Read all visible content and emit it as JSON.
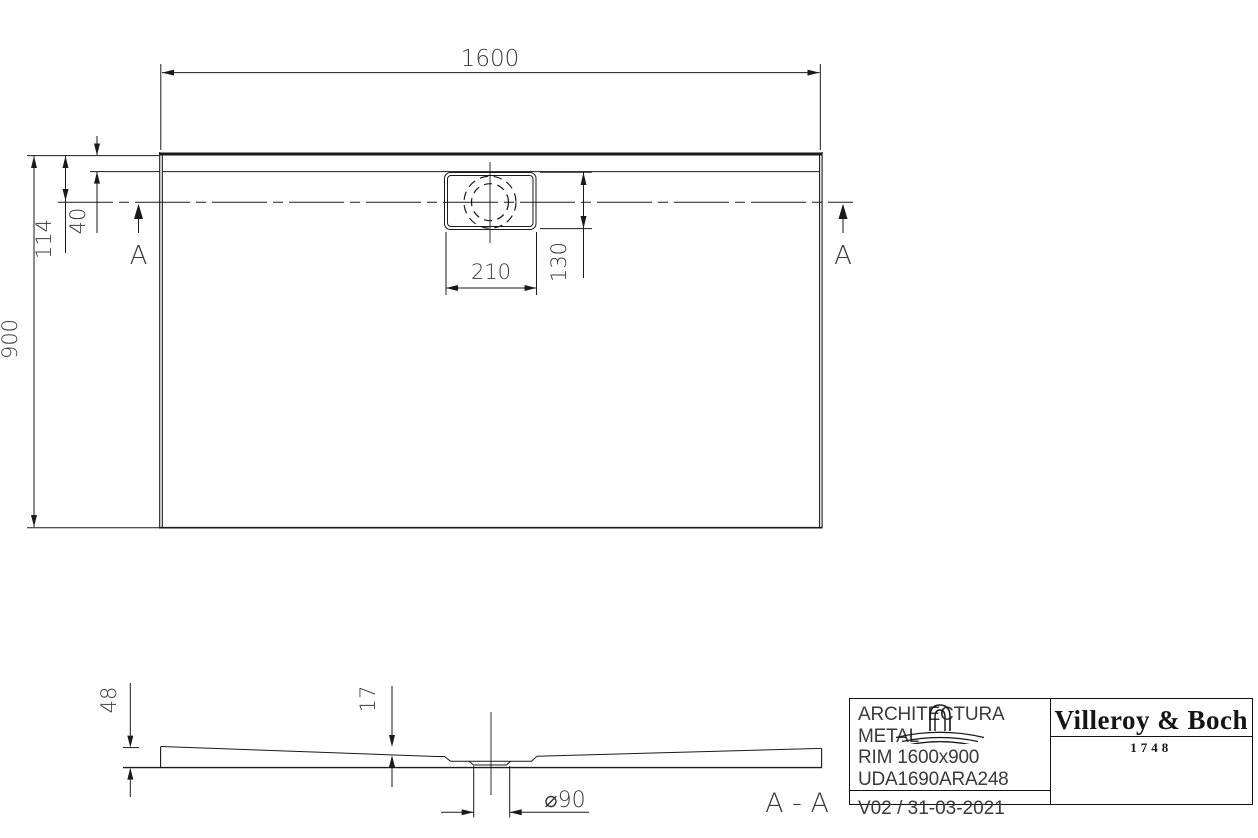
{
  "plan": {
    "width": "1600",
    "height": "900",
    "edge_to_drain_center": "114",
    "rim_width": "40",
    "drain_box_width": "210",
    "drain_offset": "130",
    "section_marker": "A"
  },
  "section": {
    "label": "A - A",
    "tray_height": "48",
    "floor_thickness": "17",
    "drain_diameter": "⌀90"
  },
  "title_block": {
    "product_name": "ARCHITECTURA METAL",
    "product_type": "RIM 1600x900",
    "article_number": "UDA1690ARA248",
    "version_date": "V02 / 31-03-2021",
    "brand_name": "Villeroy & Boch",
    "brand_year": "1748",
    "brand_icon": "faucet-ripples-icon"
  },
  "colors": {
    "line": "#1a1a1a",
    "dim_text": "#3a3a3a",
    "background": "#ffffff"
  }
}
